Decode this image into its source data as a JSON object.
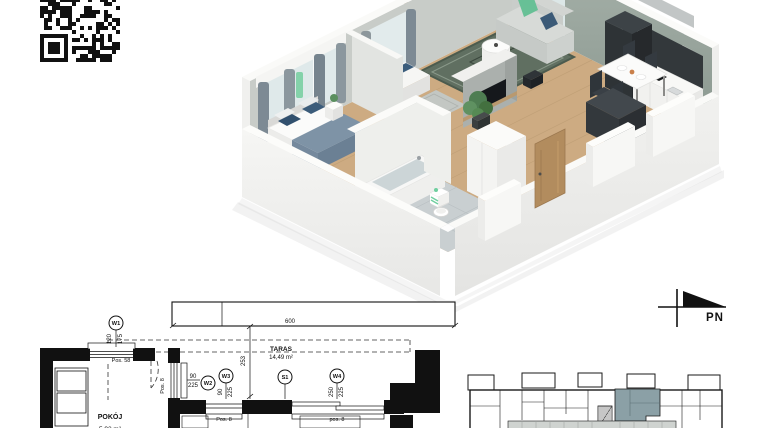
{
  "document": {
    "type": "apartment-floor-plan-card"
  },
  "colors": {
    "keyplan_highlight": "#8ba0a6",
    "accent_mint": "#7fd3a9",
    "wood_floor": "#cdab82",
    "wall_sage": "#9aa79f"
  },
  "north_arrow": {
    "label": "PN"
  },
  "plan2d": {
    "terrace_label": "TARAS",
    "terrace_area": "14,49 m²",
    "room_label": "POKÓJ",
    "room_area": "5,92 m²",
    "dim_width": "600",
    "dim_depth": "253",
    "pos_58": "Pos. 58",
    "pos_8_door": "Pos. 8",
    "pos_8_w3": "Pos. 8",
    "pos_8_w4": "pos. 8",
    "markers": {
      "w1": {
        "id": "W1",
        "d1": "120",
        "d2": "175"
      },
      "w2": {
        "id": "W2",
        "d1": "90",
        "d2": "225"
      },
      "w3": {
        "id": "W3",
        "d1": "90",
        "d2": "225"
      },
      "s1": {
        "id": "S1"
      },
      "w4": {
        "id": "W4",
        "d1": "250",
        "d2": "225"
      }
    }
  }
}
